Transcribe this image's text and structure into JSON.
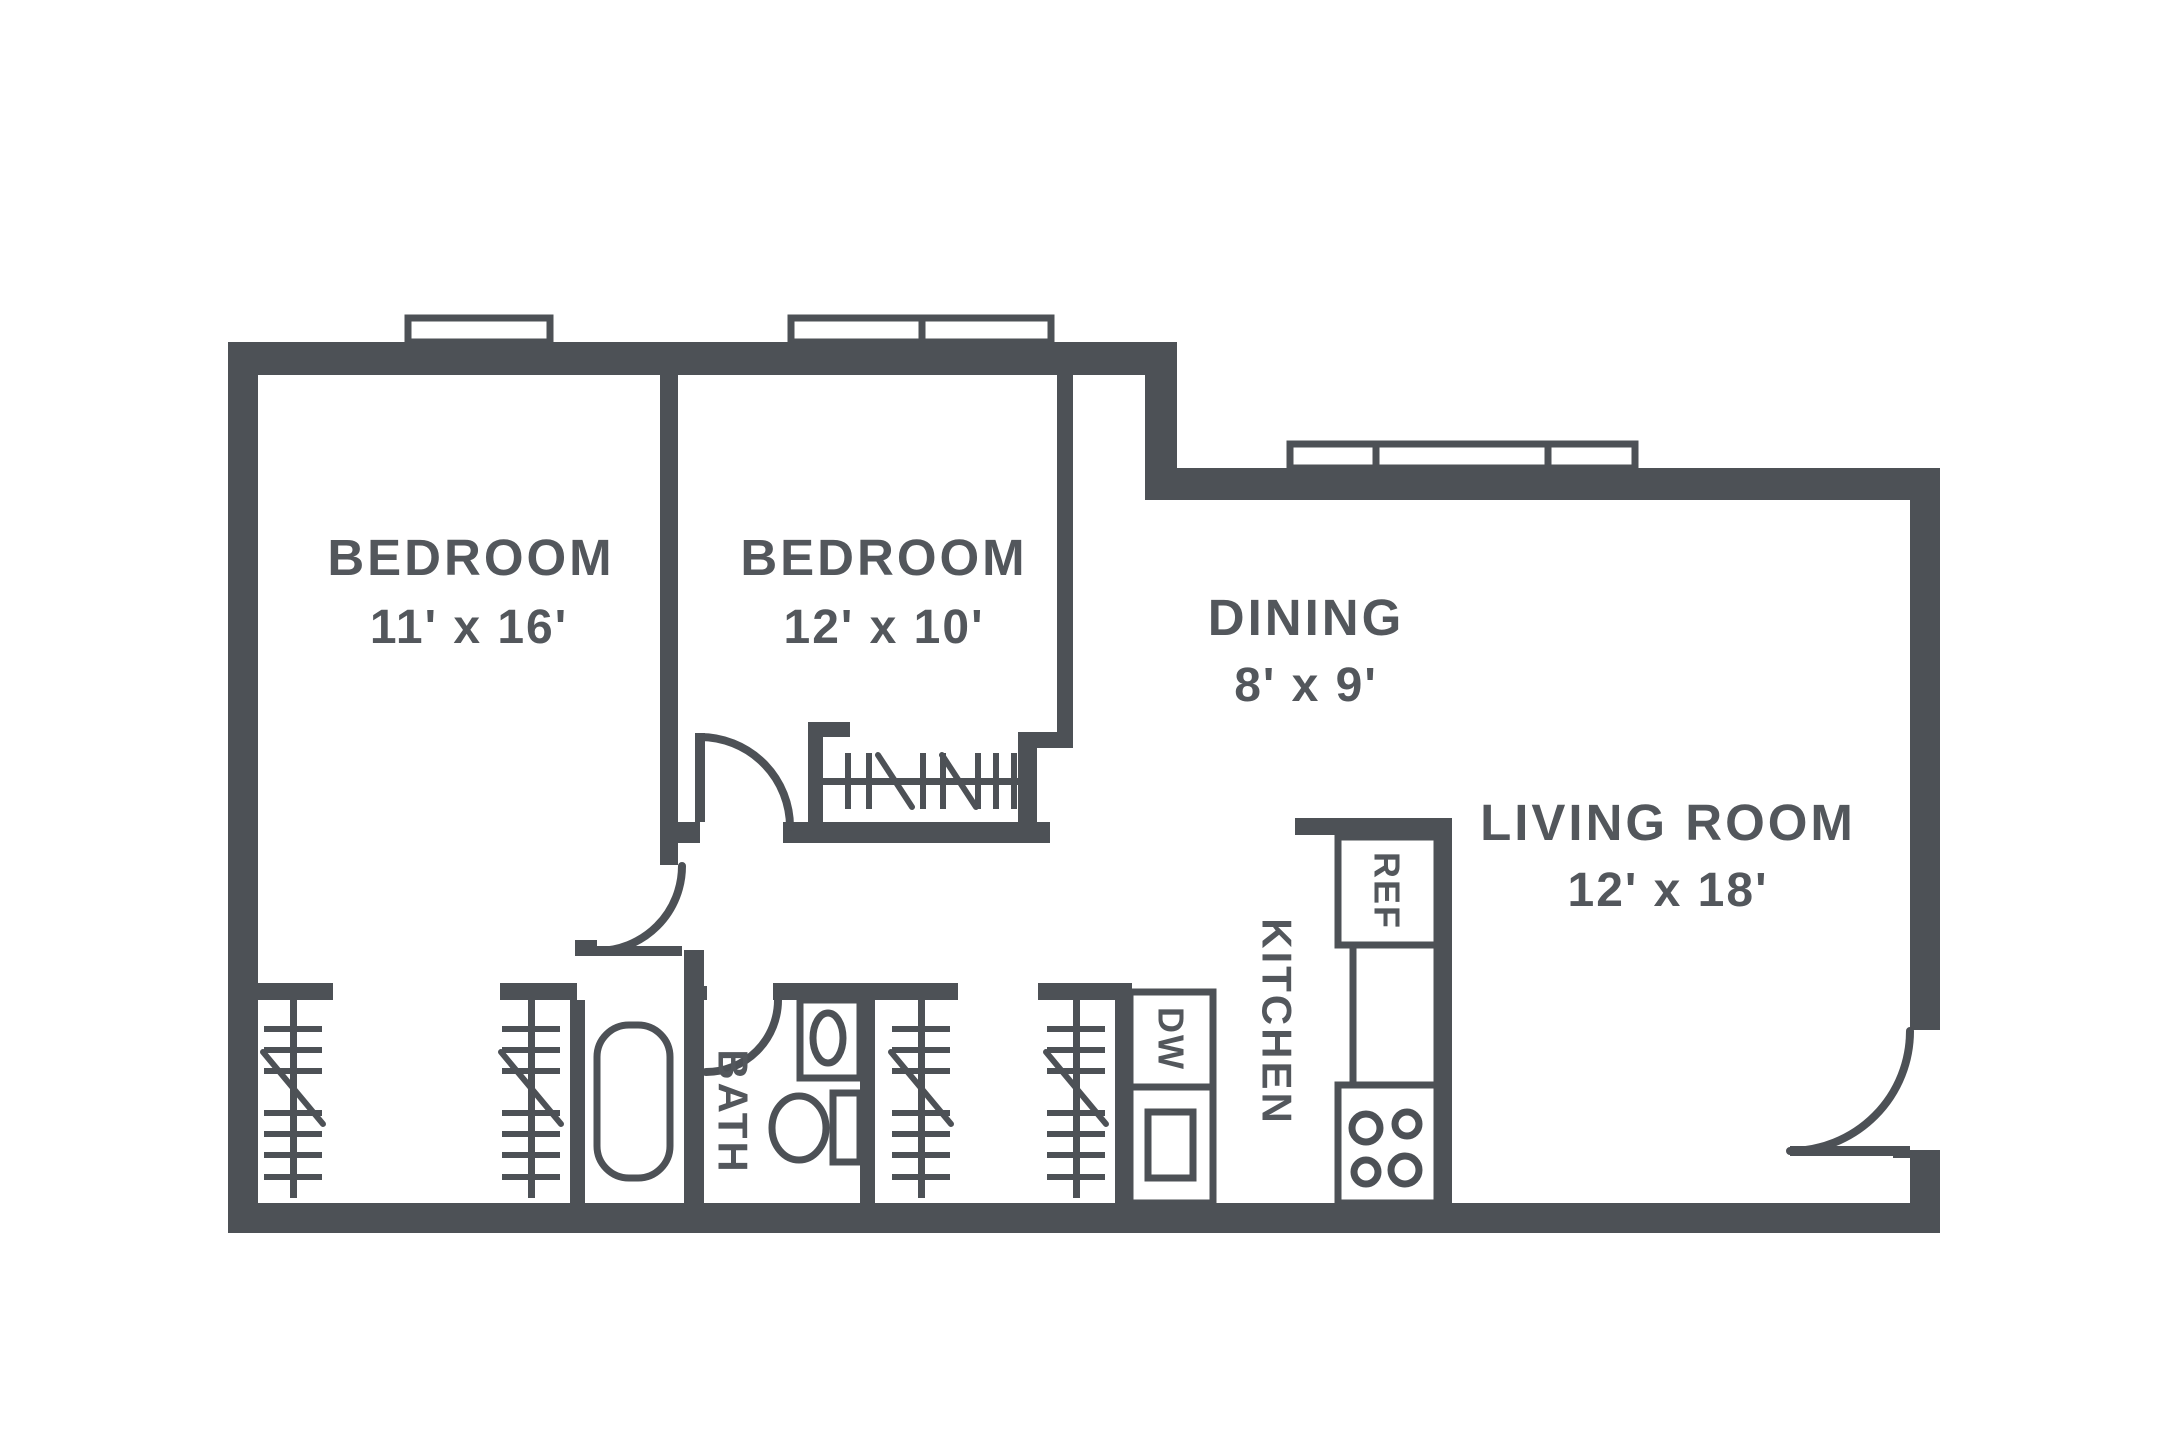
{
  "colors": {
    "wall": "#4d5156",
    "text": "#53575c",
    "background": "#ffffff"
  },
  "rooms": [
    {
      "id": "bedroom-1",
      "name": "BEDROOM",
      "dims": "11' x 16'"
    },
    {
      "id": "bedroom-2",
      "name": "BEDROOM",
      "dims": "12' x 10'"
    },
    {
      "id": "dining",
      "name": "DINING",
      "dims": "8' x 9'"
    },
    {
      "id": "living-room",
      "name": "LIVING ROOM",
      "dims": "12' x 18'"
    },
    {
      "id": "kitchen",
      "name": "KITCHEN"
    },
    {
      "id": "bath",
      "name": "BATH"
    }
  ],
  "appliances": [
    {
      "id": "refrigerator",
      "label": "REF"
    },
    {
      "id": "dishwasher",
      "label": "DW"
    }
  ]
}
